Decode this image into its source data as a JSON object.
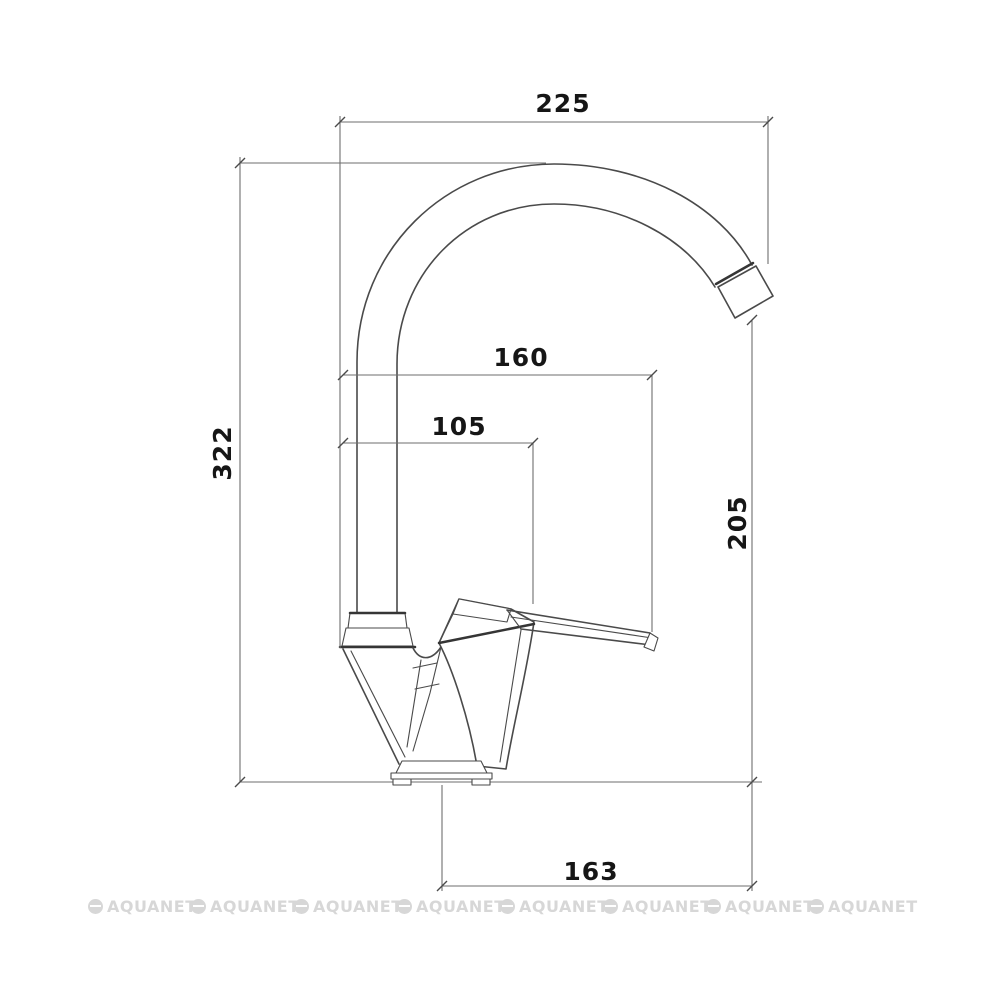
{
  "drawing": {
    "line_color": "#4a4a4a",
    "dim_line_color": "#6e6e6e",
    "text_color": "#161616",
    "background": "#ffffff"
  },
  "dims": {
    "spout_width": "225",
    "total_height": "322",
    "lever_reach": "160",
    "handle_offset": "105",
    "spout_height": "205",
    "base_reach": "163"
  },
  "watermark": {
    "label": "AQUANET",
    "count": 8,
    "color": "#d7d7d7"
  }
}
